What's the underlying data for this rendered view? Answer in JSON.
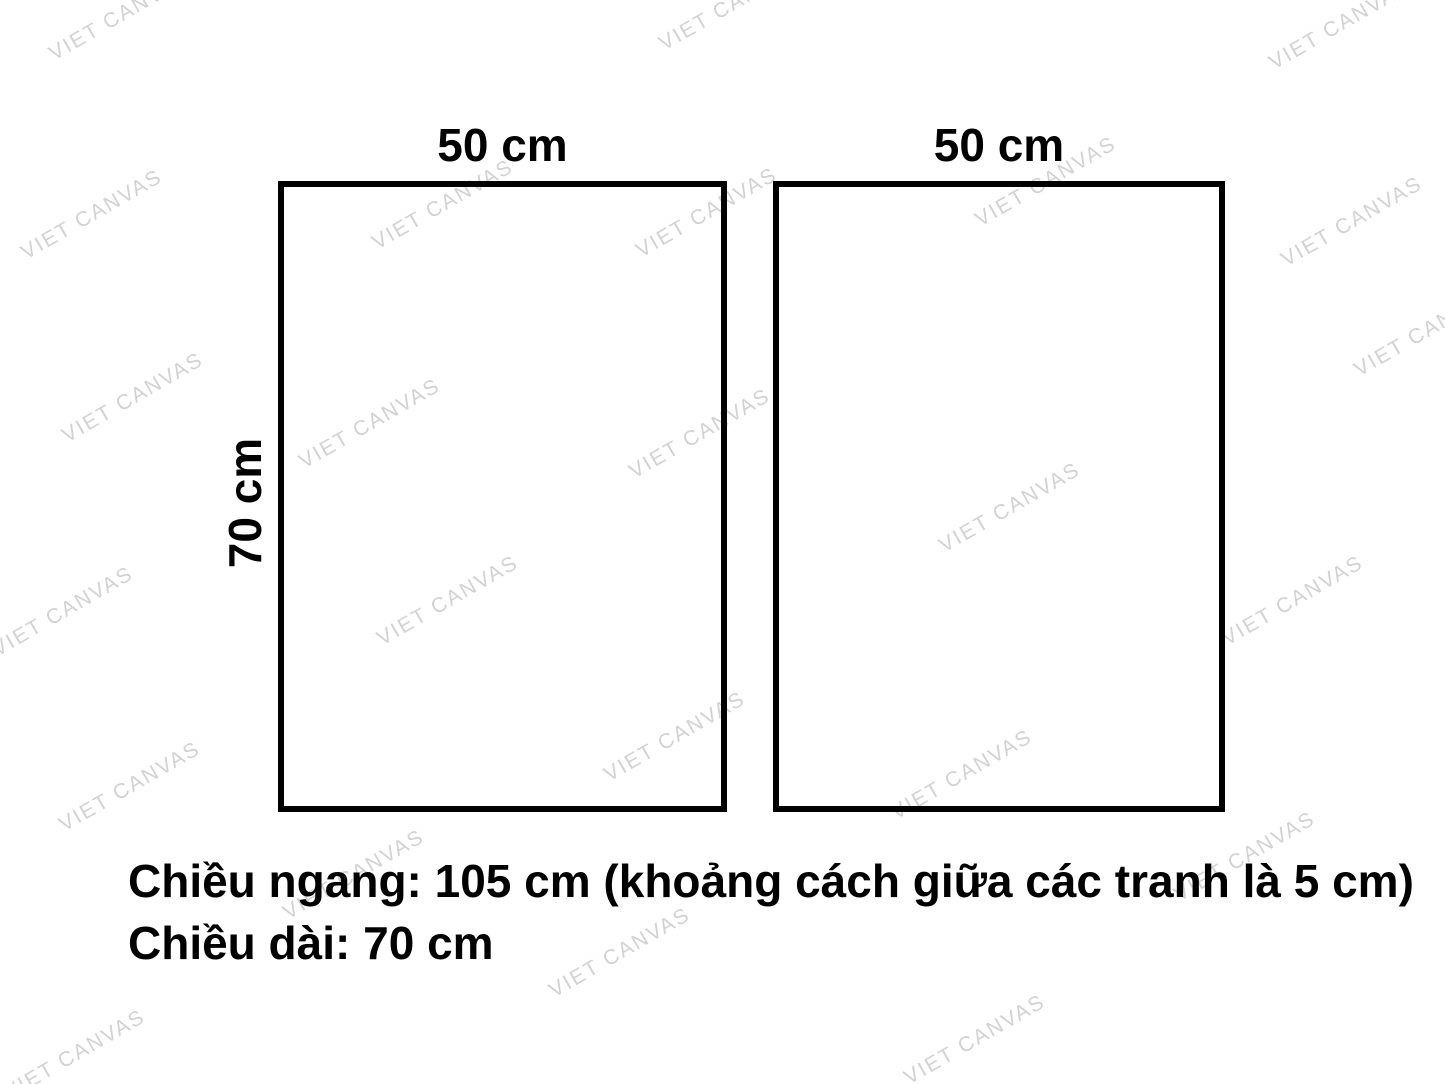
{
  "diagram": {
    "frames": [
      {
        "name": "left-frame",
        "width_label": "50 cm",
        "height_label": "70 cm"
      },
      {
        "name": "right-frame",
        "width_label": "50 cm"
      }
    ],
    "caption": {
      "line1": "Chiều ngang: 105 cm (khoảng cách giữa các tranh là 5 cm)",
      "line2": "Chiều dài: 70 cm"
    }
  },
  "colors": {
    "background": "#ffffff",
    "frame_border": "#000000",
    "text": "#000000",
    "watermark": "#d2d2d2"
  },
  "watermark": {
    "text": "VIET CANVAS",
    "angle_deg": -30,
    "positions": [
      [
        120,
        16
      ],
      [
        730,
        6
      ],
      [
        1340,
        25
      ],
      [
        92,
        215
      ],
      [
        443,
        205
      ],
      [
        707,
        213
      ],
      [
        1046,
        182
      ],
      [
        1352,
        222
      ],
      [
        133,
        398
      ],
      [
        370,
        424
      ],
      [
        700,
        434
      ],
      [
        1425,
        332
      ],
      [
        63,
        612
      ],
      [
        448,
        601
      ],
      [
        1010,
        508
      ],
      [
        1293,
        601
      ],
      [
        130,
        787
      ],
      [
        675,
        737
      ],
      [
        962,
        775
      ],
      [
        1245,
        857
      ],
      [
        354,
        875
      ],
      [
        620,
        953
      ],
      [
        75,
        1055
      ],
      [
        975,
        1040
      ]
    ]
  }
}
